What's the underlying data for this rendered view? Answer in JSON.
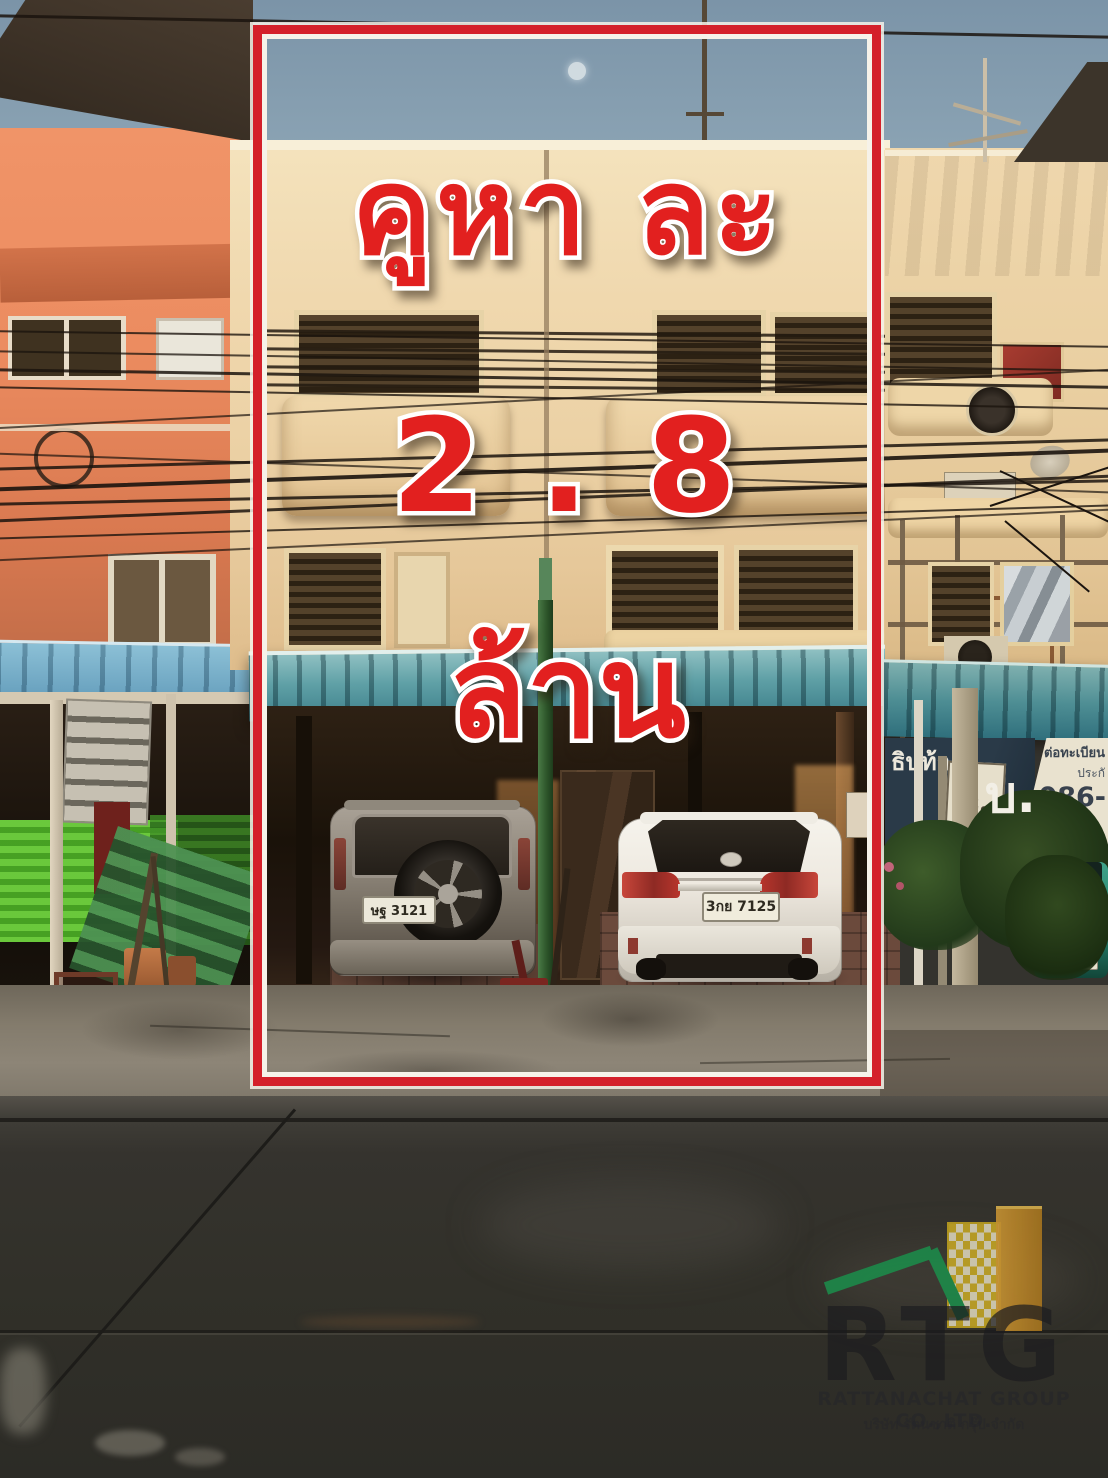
{
  "overlay": {
    "price_line1": "คูหา ละ",
    "price_line2": "2 . 8",
    "price_line3": "ล้าน"
  },
  "scene": {
    "suv_plate": "ษฐ 3121",
    "sedan_plate": "3กย 7125",
    "banner": {
      "navy_word": "ธิบท้า",
      "navy_abbrev": "บ.",
      "white_line1": "ต่อทะเบียน",
      "white_line2": "ประกั",
      "phone_partial": "086-"
    },
    "shop_sign": {
      "line1": "เบีย",
      "line2": "กันภัย"
    }
  },
  "watermark": {
    "initials": "RTG",
    "company_en": "RATTANACHAT GROUP CO.,LTD.",
    "company_th": "บริษัท รัตนชาติ กรุ๊ป จำกัด"
  },
  "colors": {
    "overlay_red": "#e2201f",
    "frame_red": "#d4202a",
    "awning_teal": "#4f929c",
    "left_building_orange": "#ee9166",
    "wall_cream": "#eed5a9",
    "sky_blue": "#7f99ac"
  }
}
